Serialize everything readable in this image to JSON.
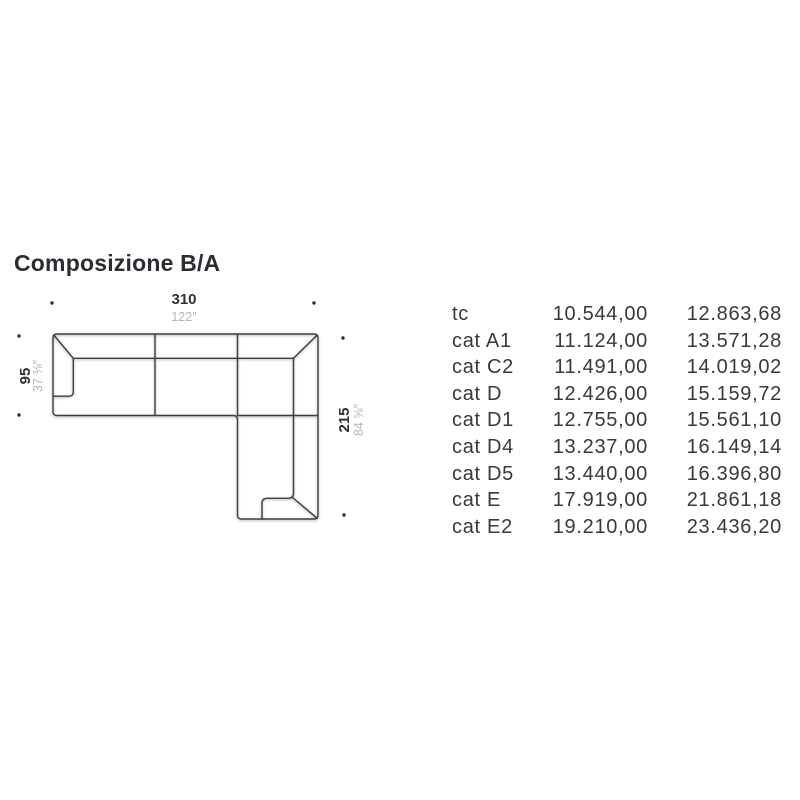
{
  "title": "Composizione B/A",
  "diagram": {
    "width_cm": "310",
    "width_in": "122″",
    "depth_cm": "95",
    "depth_in": "37 ⅜″",
    "length_cm": "215",
    "length_in": "84 ⅝″"
  },
  "price_table": {
    "rows": [
      {
        "label": "tc",
        "price_a": "10.544,00",
        "price_b": "12.863,68"
      },
      {
        "label": "cat A1",
        "price_a": "11.124,00",
        "price_b": "13.571,28"
      },
      {
        "label": "cat C2",
        "price_a": "11.491,00",
        "price_b": "14.019,02"
      },
      {
        "label": "cat D",
        "price_a": "12.426,00",
        "price_b": "15.159,72"
      },
      {
        "label": "cat D1",
        "price_a": "12.755,00",
        "price_b": "15.561,10"
      },
      {
        "label": "cat D4",
        "price_a": "13.237,00",
        "price_b": "16.149,14"
      },
      {
        "label": "cat D5",
        "price_a": "13.440,00",
        "price_b": "16.396,80"
      },
      {
        "label": "cat E",
        "price_a": "17.919,00",
        "price_b": "21.861,18"
      },
      {
        "label": "cat E2",
        "price_a": "19.210,00",
        "price_b": "23.436,20"
      }
    ]
  },
  "colors": {
    "text_dark": "#35353b",
    "text_gray": "#b5b5b7",
    "line": "#3f3f3f"
  }
}
